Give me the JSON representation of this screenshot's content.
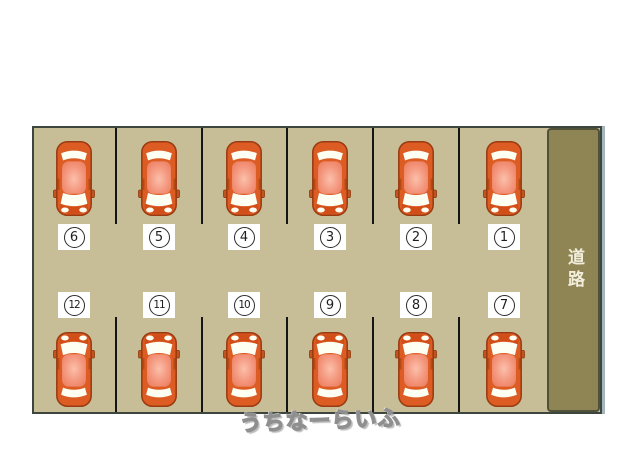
{
  "diagram": {
    "type": "parking-layout",
    "lot": {
      "fill_color": "#c7bd96",
      "border_color": "#3d453f",
      "divider_color": "#151515",
      "top_row_numbers": [
        "6",
        "5",
        "4",
        "3",
        "2",
        "1"
      ],
      "bottom_row_numbers": [
        "12",
        "11",
        "10",
        "9",
        "8",
        "7"
      ]
    },
    "road": {
      "label": "道路",
      "fill_color": "#8e8454",
      "border_color": "#4f5139",
      "text_color": "#f3eedc"
    },
    "car": {
      "body_color": "#dd5c24",
      "roof_color": "#f4977e",
      "window_color": "#fcfff2",
      "count_top_row": 6,
      "count_bottom_row": 6
    },
    "watermark": "うちなーらいふ"
  }
}
